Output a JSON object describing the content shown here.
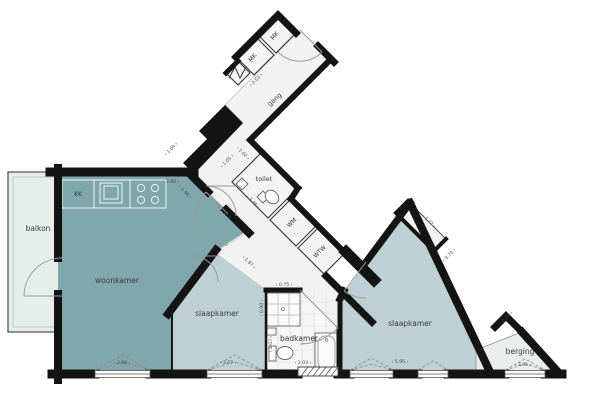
{
  "colors": {
    "woonkamer": "#7fa7ac",
    "slaapkamer": "#bdd1d5",
    "balkon": "#e6eeeb",
    "berging": "#e9edec",
    "corridor": "#f1f2f1",
    "badkamer": "#f6f6f6",
    "wall": "#141414",
    "dimension_text": "#4a4a4a",
    "label_text": "#3a3a3a"
  },
  "rooms": {
    "balkon": "balkon",
    "woonkamer": "woonkamer",
    "slaapkamer1": "slaapkamer",
    "slaapkamer2": "slaapkamer",
    "badkamer": "badkamer",
    "berging": "berging",
    "toilet": "toilet",
    "gang": "gang"
  },
  "closets": {
    "kk": "KK",
    "mk1": "MK",
    "mk2": "MK",
    "wm": "WM",
    "wtw": "WTW"
  },
  "dimensions": {
    "d_kitchen": "‹ 3.80 ›",
    "d_hal": "‹ 1.04 ›",
    "d_gang": "‹ 2.53 ›",
    "d_toilet_1": "‹ 1.05 ›",
    "d_toilet_2": "‹ 1.02 ›",
    "d_toilet_3": "‹ 1.46 ›",
    "d_hall_1": "‹ 1.96 ›",
    "d_hall_2": "‹ 1.90 ›",
    "d_bad_gap": "‹ 0.75 ›",
    "d_woonkamer": "‹ 3.88 ›",
    "d_slaap1": "‹ 3.07 ›",
    "d_slaap1_diag": "‹ 1.87 ›",
    "d_bad_w": "‹ 2.03 ›",
    "d_bad_v1": "‹ 0.90 ›",
    "d_bad_v2": "‹ 2.07 ›",
    "d_niche_1": "‹ 1.77 ›",
    "d_niche_2": "‹ 0.70 ›",
    "d_slaap2": "‹ 5.95 ›",
    "d_berging_notch": "‹ 0.77 ›",
    "d_berging": "‹ 3.95 ›"
  }
}
